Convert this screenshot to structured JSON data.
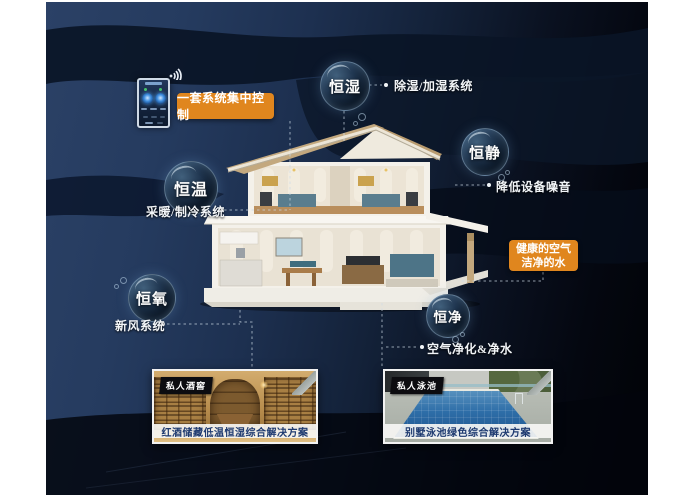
{
  "colors": {
    "accent_orange": "#e0861e",
    "background_navy": "#22365a",
    "caption_blue": "#1e3a70",
    "bubble_rim": "#a5c8e6"
  },
  "control": {
    "label": "一套系统集中控制",
    "device": "smart-control-panel",
    "wifi": "wifi-icon"
  },
  "bubbles": [
    {
      "label": "恒湿",
      "desc": "除湿/加湿系统"
    },
    {
      "label": "恒静",
      "desc": "降低设备噪音"
    },
    {
      "label": "恒温",
      "desc": "采暖/制冷系统"
    },
    {
      "label": "恒氧",
      "desc": "新风系统"
    },
    {
      "label": "恒净",
      "desc": "空气净化&净水"
    }
  ],
  "info_box": {
    "line1": "健康的空气",
    "line2": "洁净的水"
  },
  "photos": [
    {
      "tag": "私人酒窖",
      "caption": "红酒储藏低温恒湿综合解决方案"
    },
    {
      "tag": "私人泳池",
      "caption": "别墅泳池绿色综合解决方案"
    }
  ]
}
